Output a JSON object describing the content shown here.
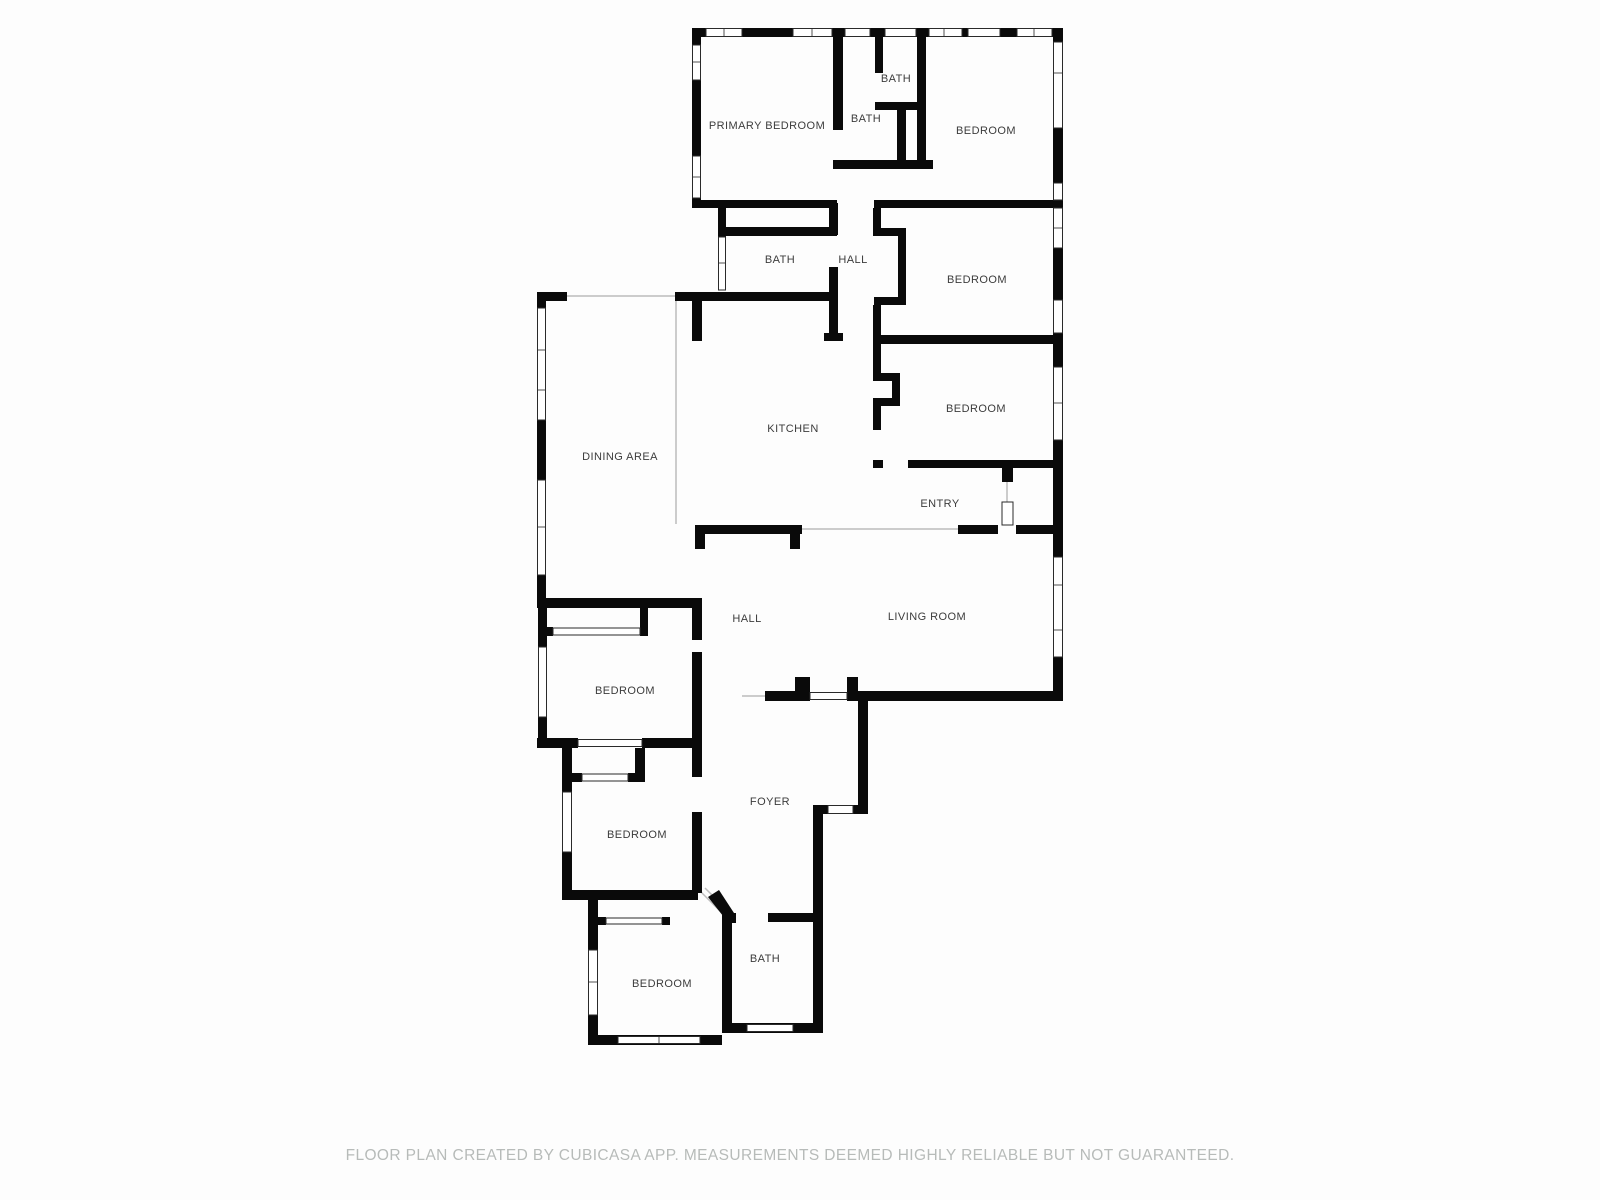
{
  "page": {
    "background": "#fdfdfd",
    "type": "floor-plan"
  },
  "floor_plan": {
    "colors": {
      "wall": "#0a0a0a",
      "window_frame": "#2a2a2a",
      "window_fill": "#ffffff",
      "ceiling_break": "#cccccc",
      "label_text": "#3c3c3c",
      "footer_text": "#b7bbb9"
    },
    "labels": [
      {
        "id": "primary-bedroom",
        "text": "PRIMARY BEDROOM",
        "x": 767,
        "y": 126
      },
      {
        "id": "bath-wc",
        "text": "BATH",
        "x": 896,
        "y": 79
      },
      {
        "id": "bath-primary",
        "text": "BATH",
        "x": 866,
        "y": 119
      },
      {
        "id": "bedroom-1",
        "text": "BEDROOM",
        "x": 986,
        "y": 131
      },
      {
        "id": "bath-hall",
        "text": "BATH",
        "x": 780,
        "y": 260
      },
      {
        "id": "hall-upper",
        "text": "HALL",
        "x": 853,
        "y": 260
      },
      {
        "id": "bedroom-2",
        "text": "BEDROOM",
        "x": 977,
        "y": 280
      },
      {
        "id": "bedroom-3",
        "text": "BEDROOM",
        "x": 976,
        "y": 409
      },
      {
        "id": "kitchen",
        "text": "KITCHEN",
        "x": 793,
        "y": 429
      },
      {
        "id": "dining-area",
        "text": "DINING AREA",
        "x": 620,
        "y": 457
      },
      {
        "id": "entry",
        "text": "ENTRY",
        "x": 940,
        "y": 504
      },
      {
        "id": "hall-lower",
        "text": "HALL",
        "x": 747,
        "y": 619
      },
      {
        "id": "living-room",
        "text": "LIVING ROOM",
        "x": 927,
        "y": 617
      },
      {
        "id": "bedroom-4",
        "text": "BEDROOM",
        "x": 625,
        "y": 691
      },
      {
        "id": "bedroom-5",
        "text": "BEDROOM",
        "x": 637,
        "y": 835
      },
      {
        "id": "foyer",
        "text": "FOYER",
        "x": 770,
        "y": 802
      },
      {
        "id": "bedroom-6",
        "text": "BEDROOM",
        "x": 662,
        "y": 984
      },
      {
        "id": "bath-lower",
        "text": "BATH",
        "x": 765,
        "y": 959
      }
    ],
    "footer": {
      "text": "FLOOR PLAN CREATED BY CUBICASA APP. MEASUREMENTS DEEMED HIGHLY RELIABLE BUT NOT GUARANTEED."
    }
  }
}
